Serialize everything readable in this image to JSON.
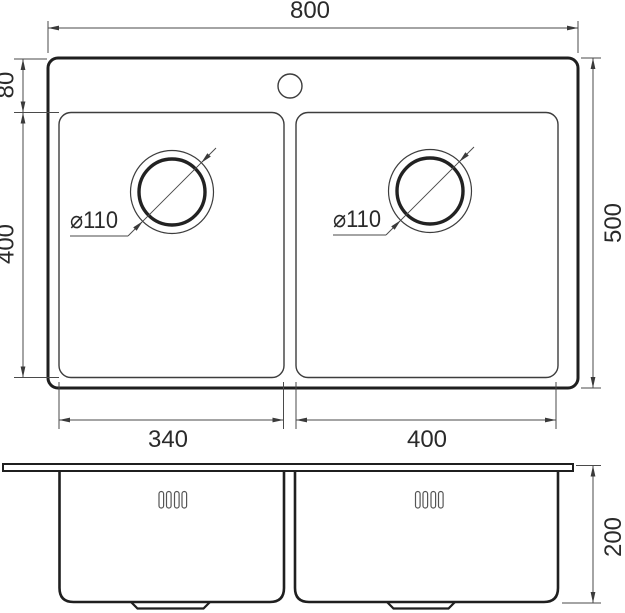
{
  "colors": {
    "background": "#ffffff",
    "outline": "#1f1f1f",
    "dimension_line": "#4a4a4a",
    "text": "#2a2a2a"
  },
  "top_view": {
    "overall_width_mm": "800",
    "rim_to_bowl_mm": "80",
    "bowl_length_mm": "400",
    "overall_depth_mm": "500",
    "left_bowl_width_mm": "340",
    "right_bowl_width_mm": "400",
    "left_drain_diameter": "⌀110",
    "right_drain_diameter": "⌀110"
  },
  "side_view": {
    "bowl_height_mm": "200"
  }
}
